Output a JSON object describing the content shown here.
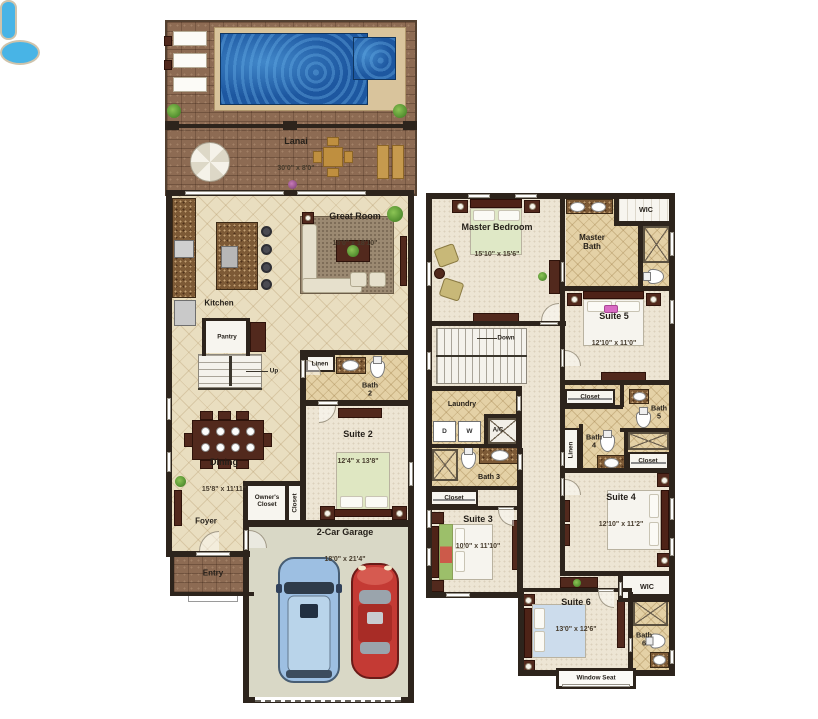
{
  "colors": {
    "wall": "#2d241c",
    "brick_deck": "#8d6b53",
    "pool_water": "#1d57a0",
    "pool_coping": "#d9c49c",
    "tile_floor": "#e9dec0",
    "carpet_floor": "#ede5d4",
    "bath_tile": "#e4d1a6",
    "garage_floor": "#d9d8c6",
    "wood_furniture": "#52291d",
    "tub_blue": "#48b4e6"
  },
  "floor1": {
    "lanai": {
      "name": "Lanai",
      "dims": "30'0\" x 8'0\""
    },
    "great_room": {
      "name": "Great Room",
      "dims": "18'0\" x 18'10\""
    },
    "kitchen": {
      "name": "Kitchen"
    },
    "pantry": {
      "name": "Pantry"
    },
    "stairs": {
      "label": "Up"
    },
    "linen": {
      "name": "Linen"
    },
    "bath2": {
      "name": "Bath\n2"
    },
    "suite2": {
      "name": "Suite 2",
      "dims": "12'4\" x 13'8\""
    },
    "dining": {
      "name": "Dining",
      "dims": "15'8\" x 11'11\""
    },
    "foyer": {
      "name": "Foyer"
    },
    "owners_closet": {
      "name": "Owner's\nCloset"
    },
    "closet": {
      "name": "Closet"
    },
    "entry": {
      "name": "Entry"
    },
    "garage": {
      "name": "2-Car Garage",
      "dims": "18'0\" x 21'4\""
    }
  },
  "floor2": {
    "master_bedroom": {
      "name": "Master Bedroom",
      "dims": "15'10\" x 15'6\""
    },
    "master_bath": {
      "name": "Master\nBath"
    },
    "wic_master": {
      "name": "WIC"
    },
    "suite5": {
      "name": "Suite 5",
      "dims": "12'10\" x 11'0\""
    },
    "stairs": {
      "label": "Down"
    },
    "laundry": {
      "name": "Laundry",
      "dryer": "D",
      "washer": "W",
      "ac": "A/C"
    },
    "bath3": {
      "name": "Bath 3"
    },
    "closet_suite3": {
      "name": "Closet"
    },
    "suite3": {
      "name": "Suite 3",
      "dims": "10'0\" x 11'10\""
    },
    "closet_suite5": {
      "name": "Closet"
    },
    "bath5": {
      "name": "Bath\n5"
    },
    "bath4": {
      "name": "Bath\n4"
    },
    "linen": {
      "name": "Linen"
    },
    "closet_bath": {
      "name": "Closet"
    },
    "suite4": {
      "name": "Suite 4",
      "dims": "12'10\" x 11'2\""
    },
    "wic_suite6": {
      "name": "WIC"
    },
    "suite6": {
      "name": "Suite 6",
      "dims": "13'0\" x 12'6\""
    },
    "bath6": {
      "name": "Bath\n6"
    },
    "window_seat": {
      "name": "Window Seat"
    }
  }
}
